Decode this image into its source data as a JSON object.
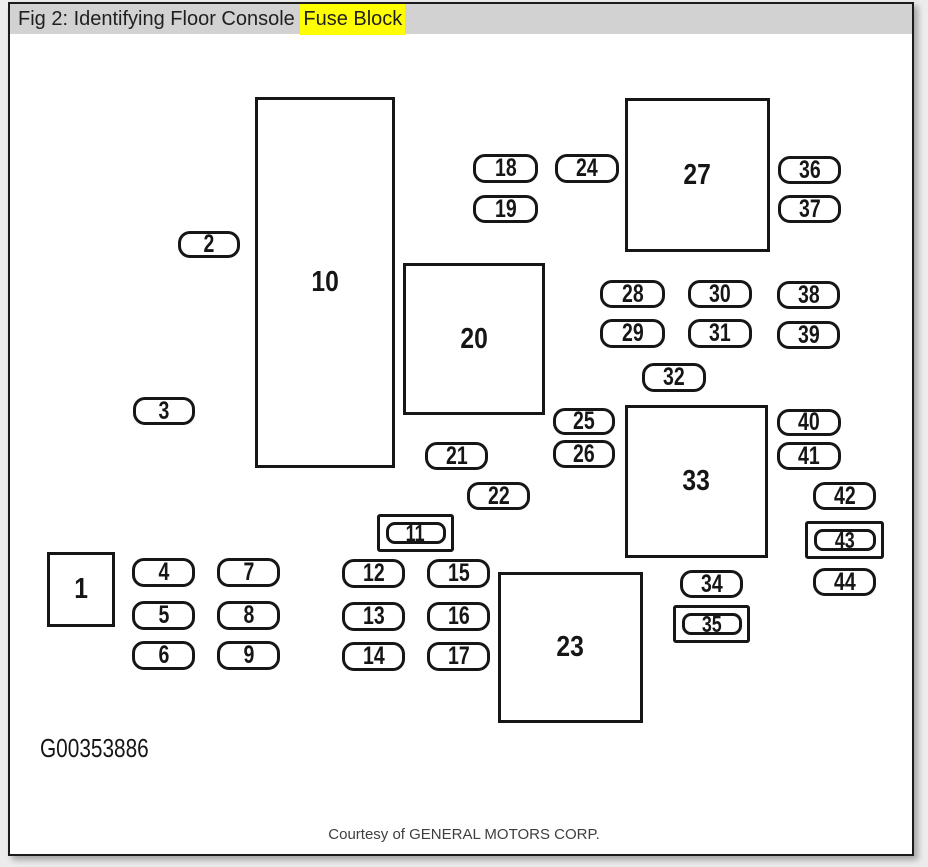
{
  "header": {
    "title_prefix": "Fig 2: Identifying Floor Console ",
    "title_highlight": "Fuse Block"
  },
  "colors": {
    "highlight": "#ffff00",
    "title_bar_bg": "#d2d2d2",
    "ink": "#161616",
    "page_bg": "#ffffff",
    "outer_bg": "#ececec"
  },
  "footer": {
    "figure_code": "G00353886",
    "courtesy": "Courtesy of GENERAL MOTORS CORP."
  },
  "diagram": {
    "description": "Floor console fuse block layout: numbered fuse slots (rounded pills), relay/component blocks (large rectangles), double-framed slots 11, 35 and 43",
    "items": [
      {
        "type": "block",
        "label": "1",
        "x": 47,
        "y": 552,
        "w": 68,
        "h": 75
      },
      {
        "type": "pill",
        "label": "2",
        "x": 178,
        "y": 231,
        "w": 62,
        "h": 27
      },
      {
        "type": "pill",
        "label": "3",
        "x": 133,
        "y": 397,
        "w": 62,
        "h": 28
      },
      {
        "type": "pill",
        "label": "4",
        "x": 132,
        "y": 558,
        "w": 63,
        "h": 29
      },
      {
        "type": "pill",
        "label": "5",
        "x": 132,
        "y": 601,
        "w": 63,
        "h": 29
      },
      {
        "type": "pill",
        "label": "6",
        "x": 132,
        "y": 641,
        "w": 63,
        "h": 29
      },
      {
        "type": "pill",
        "label": "7",
        "x": 217,
        "y": 558,
        "w": 63,
        "h": 29
      },
      {
        "type": "pill",
        "label": "8",
        "x": 217,
        "y": 601,
        "w": 63,
        "h": 29
      },
      {
        "type": "pill",
        "label": "9",
        "x": 217,
        "y": 641,
        "w": 63,
        "h": 29
      },
      {
        "type": "block",
        "label": "10",
        "x": 255,
        "y": 97,
        "w": 140,
        "h": 371
      },
      {
        "type": "double",
        "label": "11",
        "x": 377,
        "y": 514,
        "w": 77,
        "h": 38
      },
      {
        "type": "pill",
        "label": "12",
        "x": 342,
        "y": 559,
        "w": 63,
        "h": 29
      },
      {
        "type": "pill",
        "label": "13",
        "x": 342,
        "y": 602,
        "w": 63,
        "h": 29
      },
      {
        "type": "pill",
        "label": "14",
        "x": 342,
        "y": 642,
        "w": 63,
        "h": 29
      },
      {
        "type": "pill",
        "label": "15",
        "x": 427,
        "y": 559,
        "w": 63,
        "h": 29
      },
      {
        "type": "pill",
        "label": "16",
        "x": 427,
        "y": 602,
        "w": 63,
        "h": 29
      },
      {
        "type": "pill",
        "label": "17",
        "x": 427,
        "y": 642,
        "w": 63,
        "h": 29
      },
      {
        "type": "pill",
        "label": "18",
        "x": 473,
        "y": 154,
        "w": 65,
        "h": 29
      },
      {
        "type": "pill",
        "label": "19",
        "x": 473,
        "y": 195,
        "w": 65,
        "h": 28
      },
      {
        "type": "block",
        "label": "20",
        "x": 403,
        "y": 263,
        "w": 142,
        "h": 152
      },
      {
        "type": "pill",
        "label": "21",
        "x": 425,
        "y": 442,
        "w": 63,
        "h": 28
      },
      {
        "type": "pill",
        "label": "22",
        "x": 467,
        "y": 482,
        "w": 63,
        "h": 28
      },
      {
        "type": "block",
        "label": "23",
        "x": 498,
        "y": 572,
        "w": 145,
        "h": 151
      },
      {
        "type": "pill",
        "label": "24",
        "x": 555,
        "y": 154,
        "w": 64,
        "h": 29
      },
      {
        "type": "pill",
        "label": "25",
        "x": 553,
        "y": 408,
        "w": 62,
        "h": 27
      },
      {
        "type": "pill",
        "label": "26",
        "x": 553,
        "y": 440,
        "w": 62,
        "h": 28
      },
      {
        "type": "block",
        "label": "27",
        "x": 625,
        "y": 98,
        "w": 145,
        "h": 154
      },
      {
        "type": "pill",
        "label": "28",
        "x": 600,
        "y": 280,
        "w": 65,
        "h": 28
      },
      {
        "type": "pill",
        "label": "29",
        "x": 600,
        "y": 319,
        "w": 65,
        "h": 29
      },
      {
        "type": "pill",
        "label": "30",
        "x": 688,
        "y": 280,
        "w": 64,
        "h": 28
      },
      {
        "type": "pill",
        "label": "31",
        "x": 688,
        "y": 319,
        "w": 64,
        "h": 29
      },
      {
        "type": "pill",
        "label": "32",
        "x": 642,
        "y": 363,
        "w": 64,
        "h": 29
      },
      {
        "type": "block",
        "label": "33",
        "x": 625,
        "y": 405,
        "w": 143,
        "h": 153
      },
      {
        "type": "pill",
        "label": "34",
        "x": 680,
        "y": 570,
        "w": 63,
        "h": 28
      },
      {
        "type": "double",
        "label": "35",
        "x": 673,
        "y": 605,
        "w": 77,
        "h": 38
      },
      {
        "type": "pill",
        "label": "36",
        "x": 778,
        "y": 156,
        "w": 63,
        "h": 28
      },
      {
        "type": "pill",
        "label": "37",
        "x": 778,
        "y": 195,
        "w": 63,
        "h": 28
      },
      {
        "type": "pill",
        "label": "38",
        "x": 777,
        "y": 281,
        "w": 63,
        "h": 28
      },
      {
        "type": "pill",
        "label": "39",
        "x": 777,
        "y": 321,
        "w": 63,
        "h": 28
      },
      {
        "type": "pill",
        "label": "40",
        "x": 777,
        "y": 409,
        "w": 64,
        "h": 27
      },
      {
        "type": "pill",
        "label": "41",
        "x": 777,
        "y": 442,
        "w": 64,
        "h": 28
      },
      {
        "type": "pill",
        "label": "42",
        "x": 813,
        "y": 482,
        "w": 63,
        "h": 28
      },
      {
        "type": "double",
        "label": "43",
        "x": 805,
        "y": 521,
        "w": 79,
        "h": 38
      },
      {
        "type": "pill",
        "label": "44",
        "x": 813,
        "y": 568,
        "w": 63,
        "h": 28
      }
    ]
  }
}
